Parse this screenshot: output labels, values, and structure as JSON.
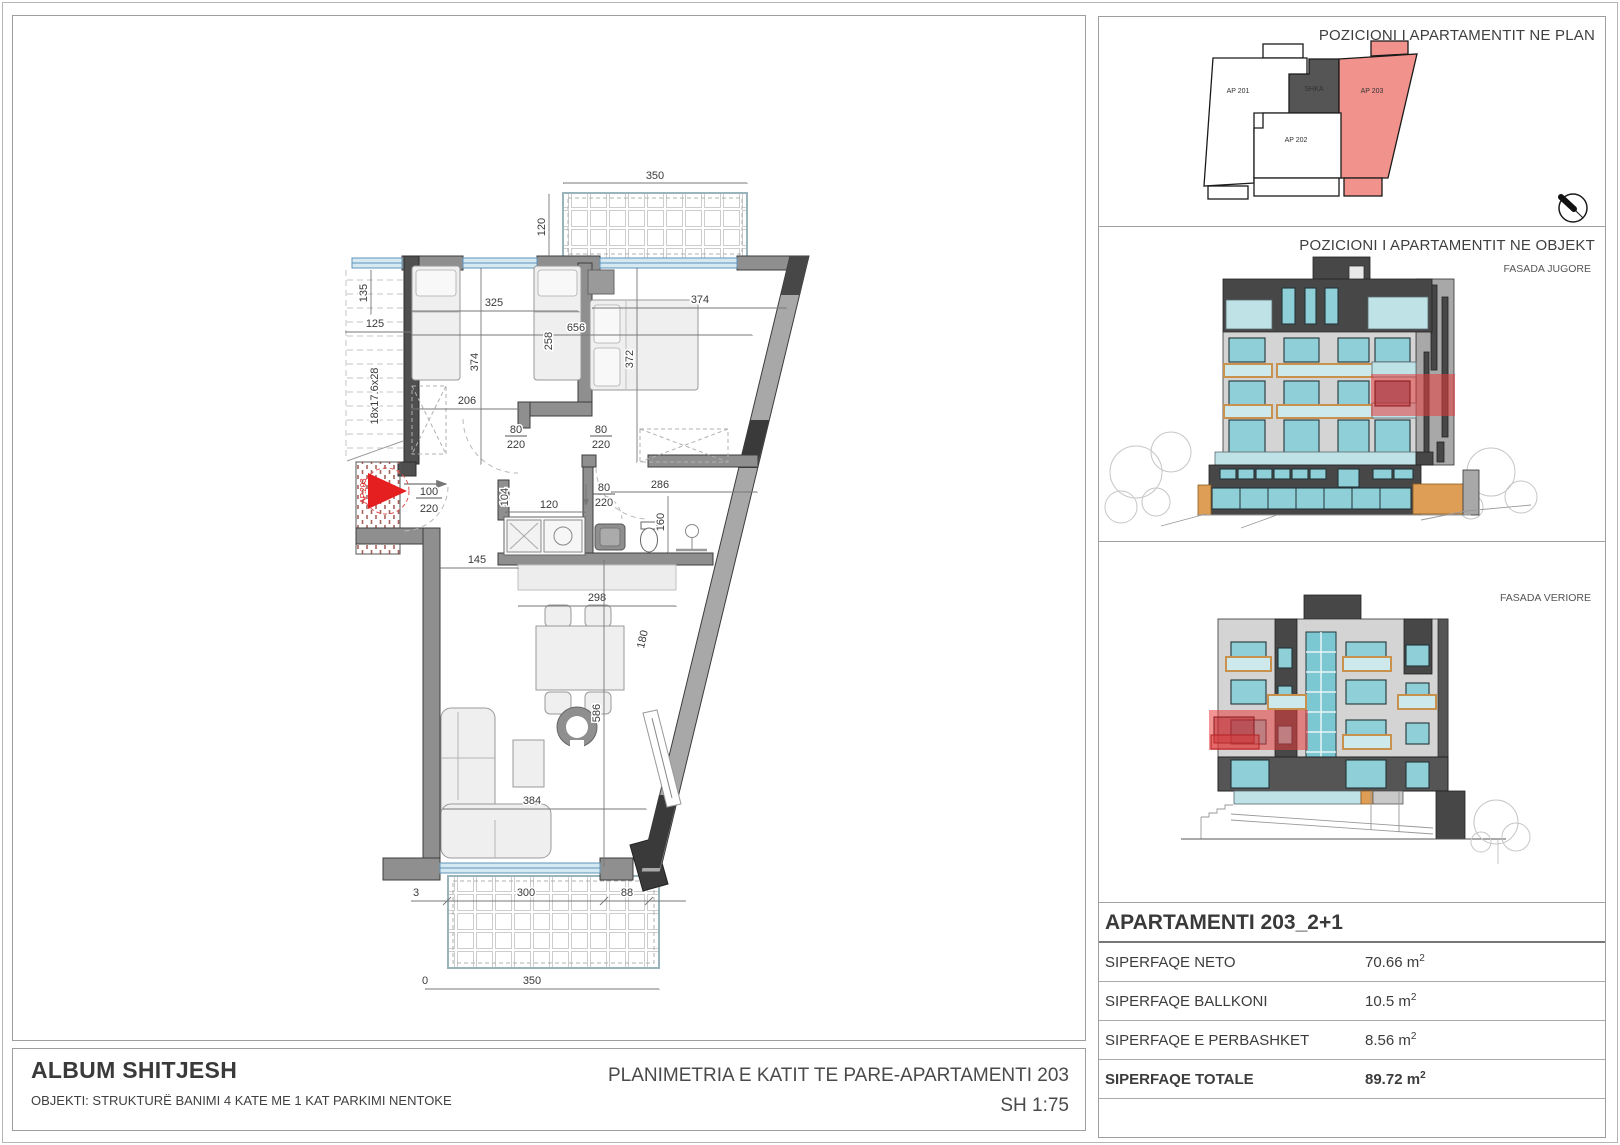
{
  "titles": {
    "pos_plan": "POZICIONI I APARTAMENTIT NE PLAN",
    "pos_objekt": "POZICIONI I APARTAMENTIT NE OBJEKT",
    "fasada_jugore": "FASADA JUGORE",
    "fasada_veriore": "FASADA VERIORE"
  },
  "mini_plan": {
    "ap201": "AP 201",
    "ap202": "AP 202",
    "ap203": "AP 203",
    "shkalla": "SHKA"
  },
  "apartment_table": {
    "title": "APARTAMENTI 203_2+1",
    "rows": [
      {
        "label": "SIPERFAQE NETO",
        "value": "70.66",
        "unit": "m",
        "sup": "2"
      },
      {
        "label": "SIPERFAQE BALLKONI",
        "value": "10.5",
        "unit": "m",
        "sup": "2"
      },
      {
        "label": "SIPERFAQE E PERBASHKET",
        "value": "8.56",
        "unit": "m",
        "sup": "2"
      },
      {
        "label": "SIPERFAQE TOTALE",
        "value": "89.72",
        "unit": "m",
        "sup": "2"
      }
    ]
  },
  "footer": {
    "album": "ALBUM SHITJESH",
    "objekti": "OBJEKTI: STRUKTURË BANIMI 4 KATE ME 1 KAT PARKIMI NENTOKE",
    "plan_title": "PLANIMETRIA E KATIT TE PARE-APARTAMENTI 203",
    "scale": "SH 1:75"
  },
  "plan": {
    "entry_stamp": "AP.203",
    "stair_note": "18x17.6x28",
    "dims": {
      "balcony_top_width": "350",
      "balcony_top_depth": "120",
      "stair_135": "135",
      "stair_125": "125",
      "bed1_width": "325",
      "bed2_width": "374",
      "total_width": "656",
      "bed1_depth": "374",
      "mid_258": "258",
      "bed2_depth": "372",
      "hall_206": "206",
      "corr_104": "104",
      "bath_286": "286",
      "bath_160": "160",
      "kitchen_120": "120",
      "hall_145": "145",
      "living_298": "298",
      "living_180": "180",
      "living_586": "586",
      "living_384": "384",
      "sbalc_3": "3",
      "sbalc_300": "300",
      "sbalc_88": "88",
      "sbalc_0": "0",
      "sbalc_350": "350"
    },
    "doors": {
      "entry": {
        "w": "100",
        "h": "220"
      },
      "bed1": {
        "w": "80",
        "h": "220"
      },
      "bed2": {
        "w": "80",
        "h": "220"
      },
      "bath": {
        "w": "80",
        "h": "220"
      }
    }
  },
  "colors": {
    "highlight_red": "#e8333a",
    "apartment_fill": "#f2928c",
    "glass_teal": "#8fd0d8",
    "balcony_tan": "#d9a96a",
    "base_orange": "#de9e55"
  }
}
